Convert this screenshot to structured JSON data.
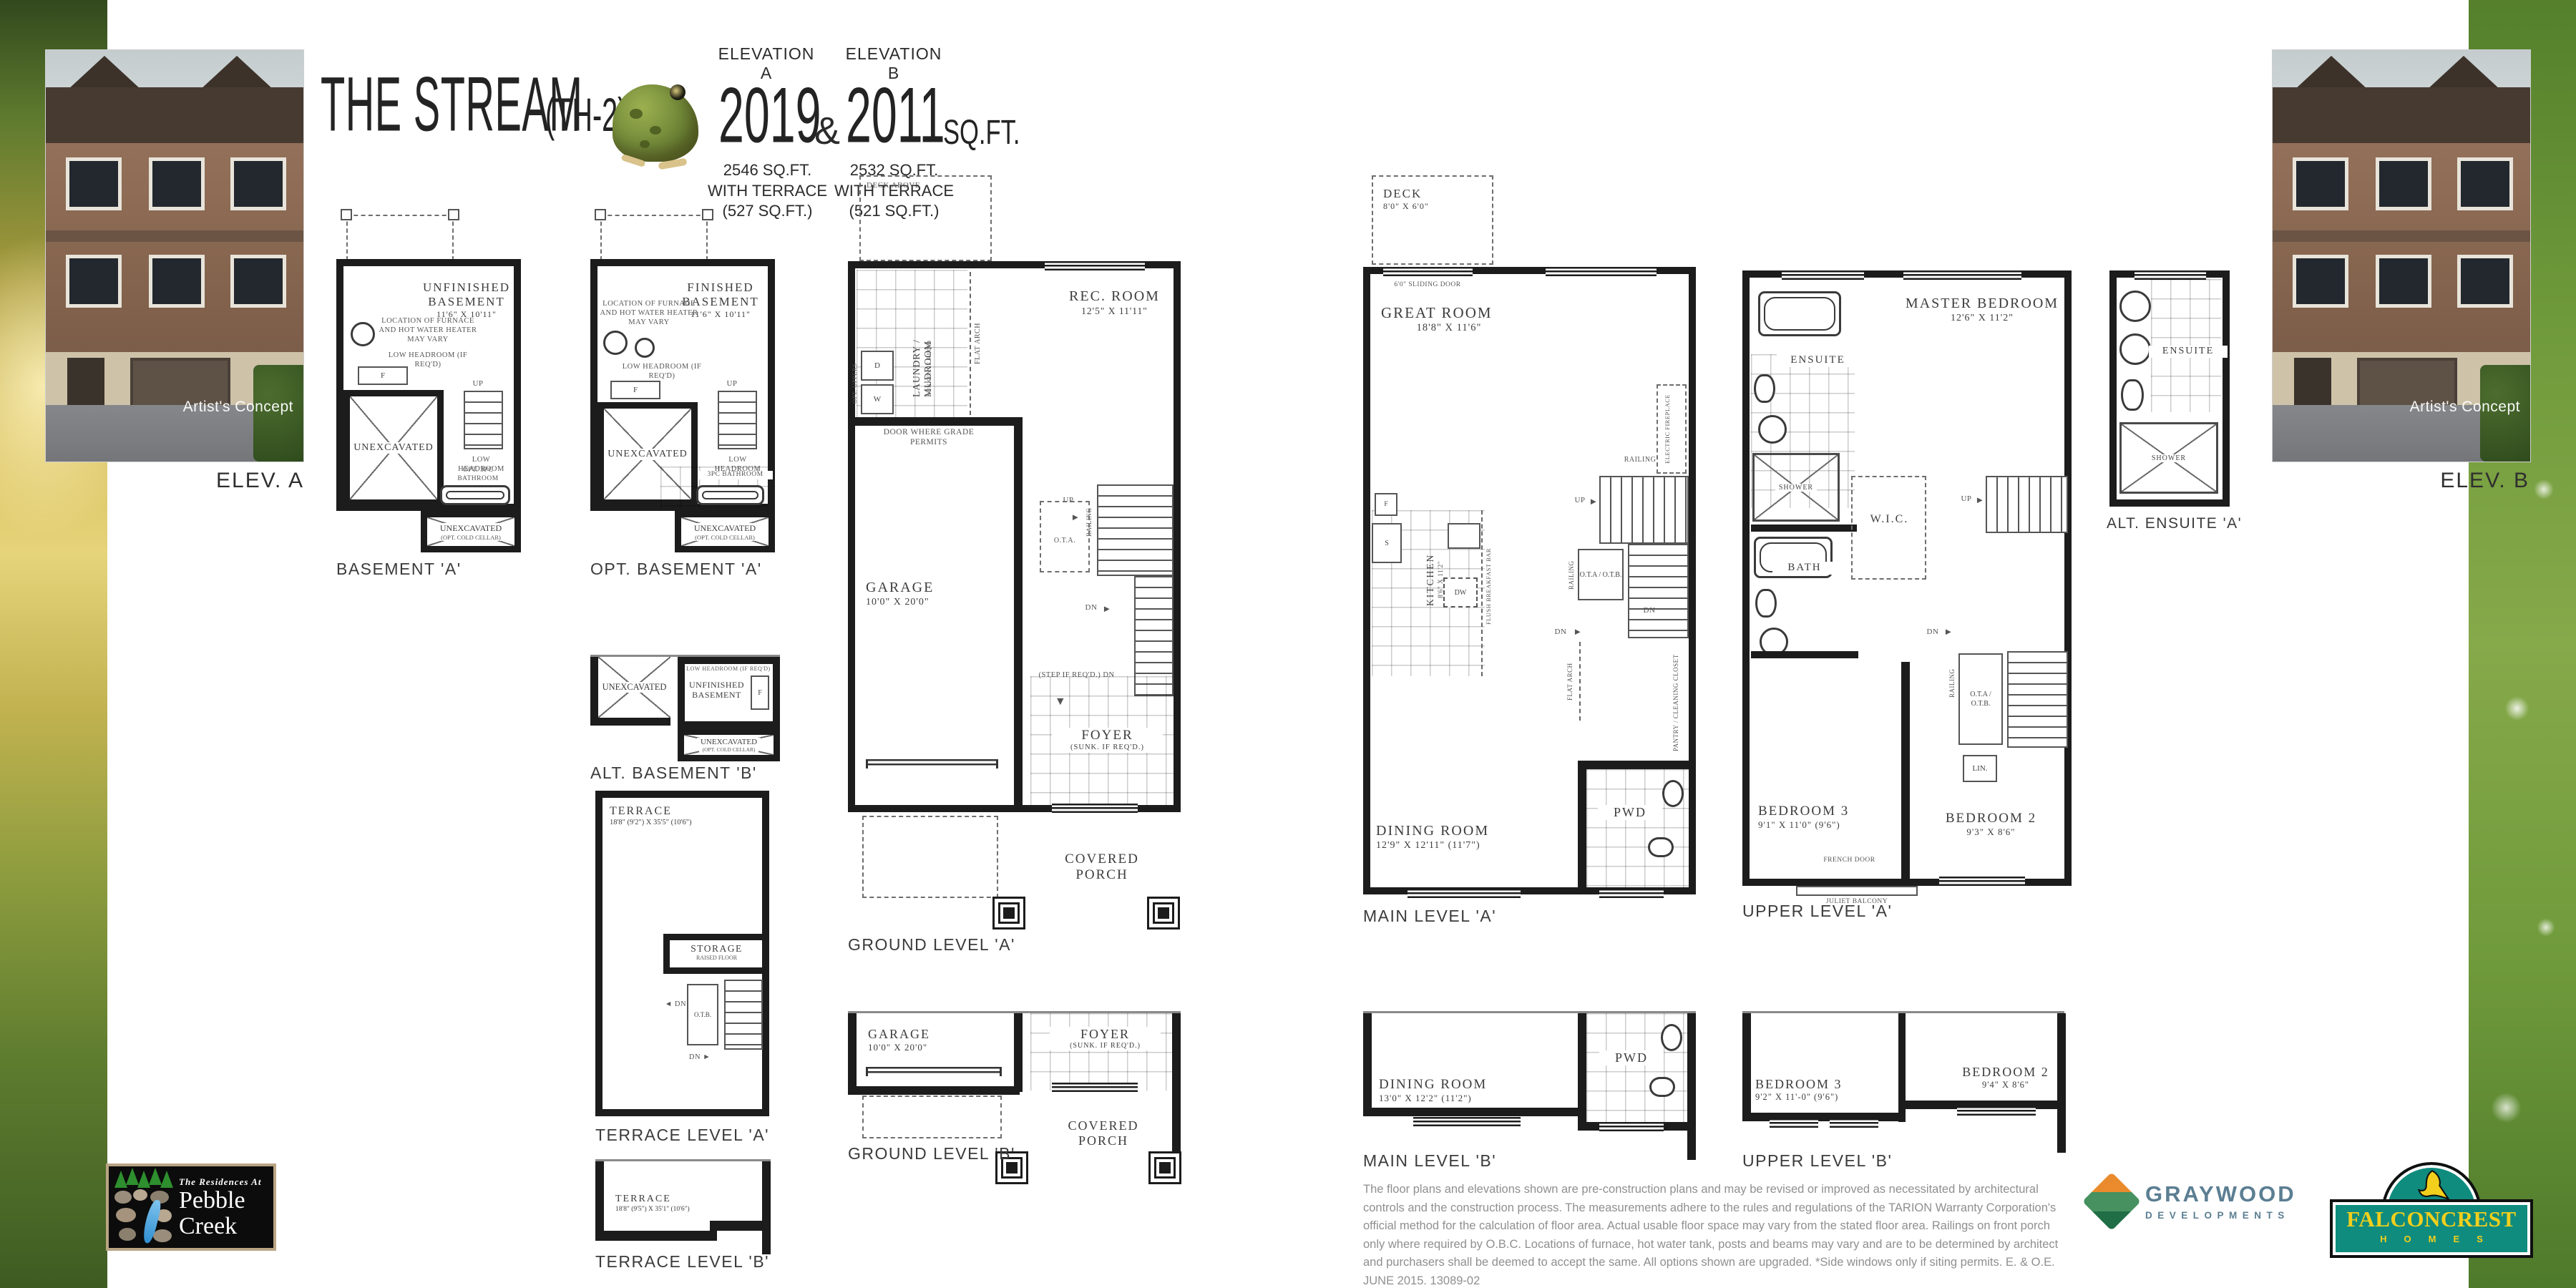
{
  "header": {
    "title": "THE STREAM",
    "title_suffix": "(TH-2)",
    "elevation_a_label": "ELEVATION A",
    "elevation_a_sqft": "2019",
    "ampersand": "&",
    "elevation_b_label": "ELEVATION B",
    "elevation_b_sqft": "2011",
    "sqft_suffix": "SQ.FT.",
    "terrace_a": [
      "2546 SQ.FT.",
      "WITH TERRACE",
      "(527 SQ.FT.)"
    ],
    "terrace_b": [
      "2532 SQ.FT.",
      "WITH TERRACE",
      "(521 SQ.FT.)"
    ]
  },
  "photos": {
    "caption": "Artist's Concept",
    "elev_a_label": "ELEV. A",
    "elev_b_label": "ELEV. B"
  },
  "common": {
    "unexcavated": "UNEXCAVATED",
    "cold_cellar": "(OPT. COLD CELLAR)",
    "up": "UP",
    "dn": "DN",
    "railing": "RAILING",
    "flat_arch": "FLAT ARCH",
    "ota_otb": "O.T.A / O.T.B.",
    "ota": "O.T.A.",
    "otb": "O.T.B.",
    "pwd": "PWD",
    "covered_porch": "COVERED PORCH",
    "shower": "SHOWER",
    "ensuite": "ENSUITE",
    "low_headroom": "LOW HEADROOM",
    "low_headroom_req": "LOW HEADROOM (IF REQ'D)",
    "furnace_note": "LOCATION OF FURNACE AND HOT WATER HEATER MAY VARY",
    "garage": "GARAGE",
    "garage_dims": "10'0\" X 20'0\"",
    "foyer": "FOYER",
    "foyer_sub": "(SUNK. IF REQ'D.)",
    "deck_above": "DECK ABOVE",
    "step_req_dn": "(STEP IF REQ'D.) DN",
    "d": "D",
    "w": "W",
    "f": "F",
    "s": "S",
    "dw": "DW",
    "lin": "LIN.",
    "up_arrow": "▼",
    "right_arrow": "►",
    "down_arrow": "▼",
    "left_arrow": "◄"
  },
  "plans": {
    "b_a": {
      "label": "BASEMENT 'A'",
      "name": "UNFINISHED BASEMENT",
      "dims": "11'6\" X 10'11\"",
      "opt_bath": "OPT. 3PC BATHROOM"
    },
    "opt_b_a": {
      "label": "OPT. BASEMENT 'A'",
      "name": "FINISHED BASEMENT",
      "dims": "11'6\" X 10'11\"",
      "bath": "3PC BATHROOM"
    },
    "alt_b_b": {
      "label": "ALT. BASEMENT 'B'",
      "name": "UNFINISHED BASEMENT"
    },
    "ter_a": {
      "label": "TERRACE LEVEL 'A'",
      "name": "TERRACE",
      "dims": "18'8\" (9'2\") X 35'5\" (10'6\")",
      "storage": "STORAGE",
      "storage_sub": "RAISED FLOOR"
    },
    "ter_b": {
      "label": "TERRACE LEVEL 'B'",
      "name": "TERRACE",
      "dims": "18'8\" (9'5\") X 35'1\" (10'6\")"
    },
    "gr_a": {
      "label": "GROUND LEVEL 'A'",
      "rec": "REC. ROOM",
      "rec_dims": "12'5\" X 11'11\"",
      "laundry": "LAUNDRY / MUDROOM",
      "laundry_sub": "SUNKEN IF REQ'D",
      "door_note": "DOOR WHERE GRADE PERMITS",
      "opt_uppers": "OPT. UPPERS"
    },
    "gr_b": {
      "label": "GROUND LEVEL 'B'"
    },
    "main_a": {
      "label": "MAIN LEVEL 'A'",
      "deck": "DECK",
      "deck_dims": "8'0\" X 6'0\"",
      "sliding": "6'0\" SLIDING DOOR",
      "great": "GREAT ROOM",
      "great_dims": "18'8\" X 11'6\"",
      "fireplace": "ELECTRIC FIREPLACE",
      "kitchen": "KITCHEN",
      "kitchen_dims": "8'6\" X 11'2\"",
      "bbar": "FLUSH BREAKFAST BAR",
      "pantry": "PANTRY / CLEANING CLOSET",
      "dining": "DINING ROOM",
      "dining_dims": "12'9\" X 12'11\" (11'7\")"
    },
    "main_b": {
      "label": "MAIN LEVEL 'B'",
      "dining": "DINING ROOM",
      "dining_dims": "13'0\" X 12'2\" (11'2\")"
    },
    "up_a": {
      "label": "UPPER LEVEL 'A'",
      "master": "MASTER BEDROOM",
      "master_dims": "12'6\" X 11'2\"",
      "wic": "W.I.C.",
      "bath": "BATH",
      "bed3": "BEDROOM 3",
      "bed3_dims": "9'1\" X 11'0\" (9'6\")",
      "bed2": "BEDROOM 2",
      "bed2_dims": "9'3\" X 8'6\"",
      "french": "FRENCH DOOR",
      "juliet": "JULIET BALCONY"
    },
    "up_b": {
      "label": "UPPER LEVEL 'B'",
      "bed3": "BEDROOM 3",
      "bed3_dims": "9'2\" X 11'-0\" (9'6\")",
      "bed2": "BEDROOM 2",
      "bed2_dims": "9'4\" X 8'6\""
    },
    "alt_ens": {
      "label": "ALT. ENSUITE 'A'"
    }
  },
  "footer": {
    "disclaimer": "The floor plans and elevations shown are pre-construction plans and may be revised or improved as necessitated by architectural controls and the construction process. The measurements adhere to the rules and regulations of the TARION Warranty Corporation's official method for the calculation of floor area. Actual usable floor space may vary from the stated floor area. Railings on front porch only where required by O.B.C. Locations of furnace, hot water tank, posts and beams may vary and are to be determined by architect and purchasers shall be deemed to accept the same. All options shown are upgraded. *Side windows only if siting permits. E. & O.E. JUNE 2015. 13089-02",
    "pebble": {
      "tagline": "The Residences At",
      "name_line1": "Pebble",
      "name_line2": "Creek"
    },
    "graywood": {
      "name": "GRAYWOOD",
      "sub": "DEVELOPMENTS"
    },
    "falconcrest": {
      "name": "FALCONCREST",
      "sub": "HOMES"
    }
  }
}
